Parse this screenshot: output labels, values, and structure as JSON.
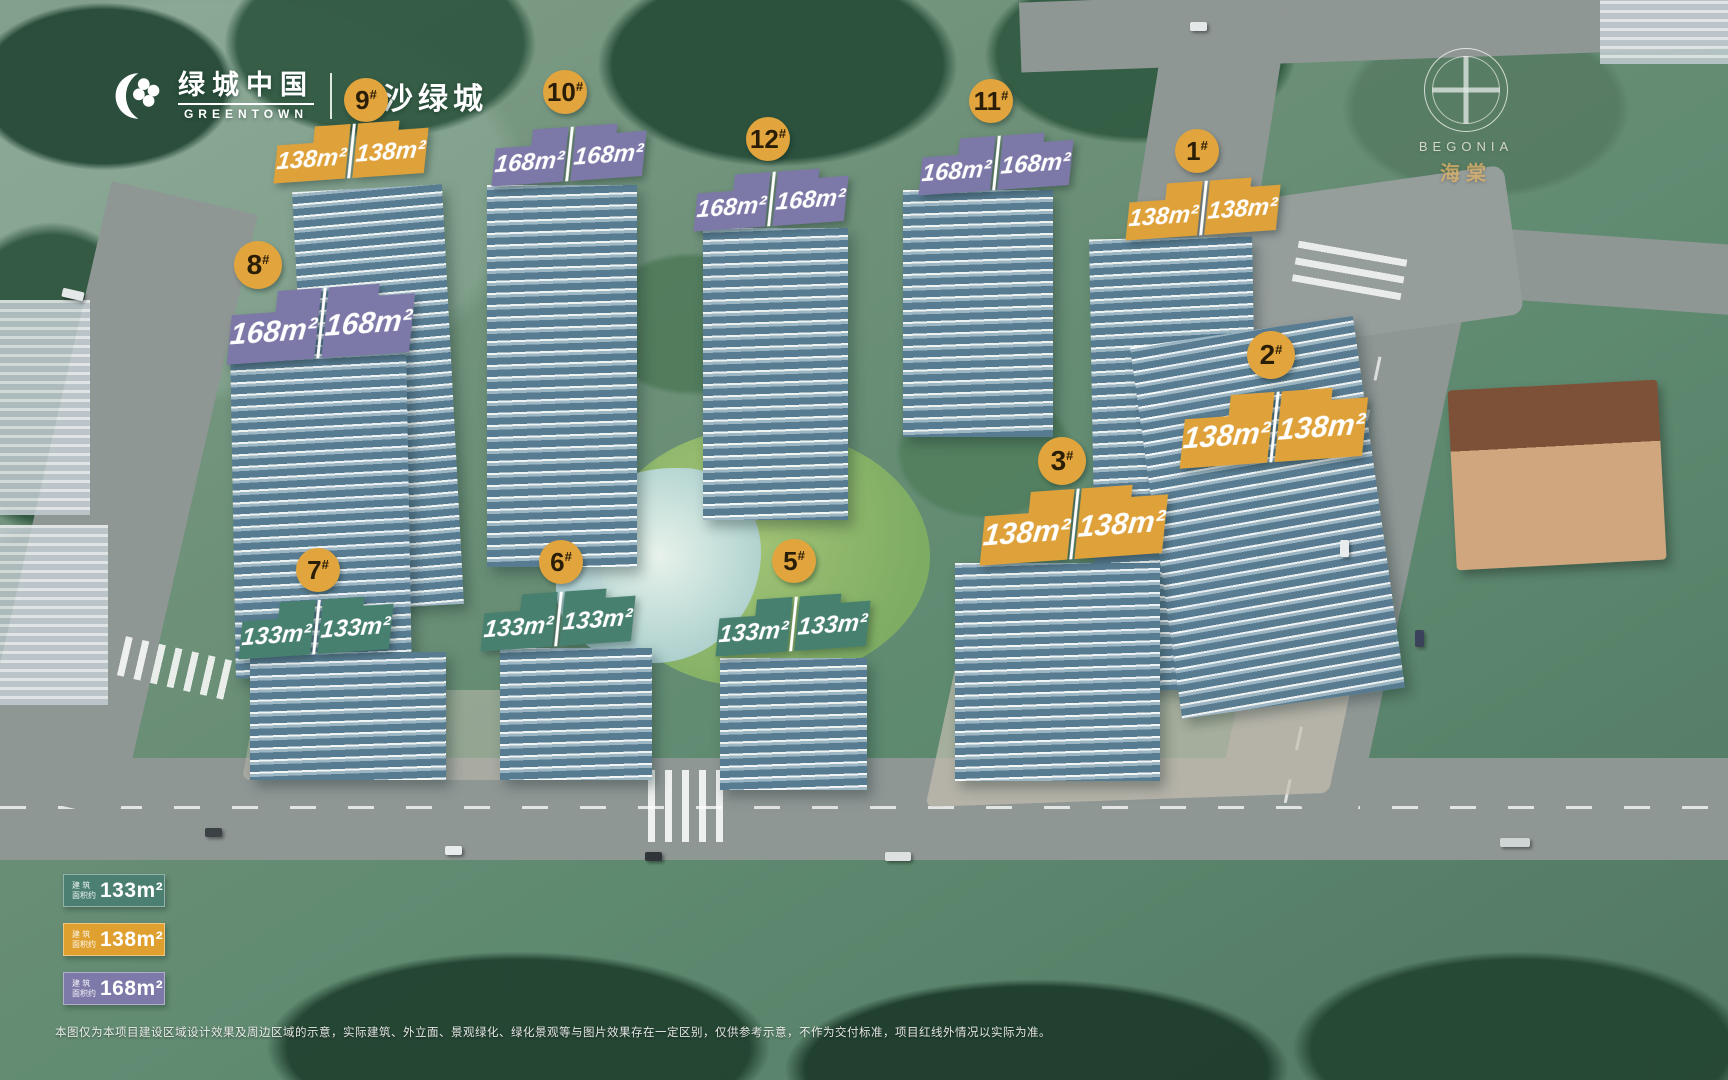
{
  "meta": {
    "hash": "#"
  },
  "header": {
    "brand_cn": "绿城中国",
    "brand_en": "GREENTOWN",
    "project": "长沙绿城"
  },
  "watermark": {
    "en": "BEGONIA",
    "cn": "海棠"
  },
  "colors": {
    "area_133": "#47806F",
    "area_138": "#DFA23B",
    "area_168": "#7C78A7",
    "badge": "#E2A53E",
    "badge_text": "#2B1E07"
  },
  "buildings": [
    {
      "number": "9",
      "palette": "orange",
      "left": "138m²",
      "right": "138m²"
    },
    {
      "number": "10",
      "palette": "purple",
      "left": "168m²",
      "right": "168m²"
    },
    {
      "number": "12",
      "palette": "purple",
      "left": "168m²",
      "right": "168m²"
    },
    {
      "number": "11",
      "palette": "purple",
      "left": "168m²",
      "right": "168m²"
    },
    {
      "number": "1",
      "palette": "orange",
      "left": "138m²",
      "right": "138m²"
    },
    {
      "number": "2",
      "palette": "orange",
      "left": "138m²",
      "right": "138m²"
    },
    {
      "number": "3",
      "palette": "orange",
      "left": "138m²",
      "right": "138m²"
    },
    {
      "number": "8",
      "palette": "purple",
      "left": "168m²",
      "right": "168m²"
    },
    {
      "number": "7",
      "palette": "green",
      "left": "133m²",
      "right": "133m²"
    },
    {
      "number": "6",
      "palette": "green",
      "left": "133m²",
      "right": "133m²"
    },
    {
      "number": "5",
      "palette": "green",
      "left": "133m²",
      "right": "133m²"
    }
  ],
  "legend": {
    "prefix_l1": "建 筑",
    "prefix_l2": "面积约",
    "items": [
      {
        "label": "133m²",
        "color": "#4A7F72"
      },
      {
        "label": "138m²",
        "color": "#DFA02F"
      },
      {
        "label": "168m²",
        "color": "#7D79A8"
      }
    ]
  },
  "disclaimer": {
    "text": "本图仅为本项目建设区域设计效果及周边区域的示意，实际建筑、外立面、景观绿化、绿化景观等与图片效果存在一定区别，仅供参考示意，不作为交付标准，项目红线外情况以实际为准。"
  }
}
